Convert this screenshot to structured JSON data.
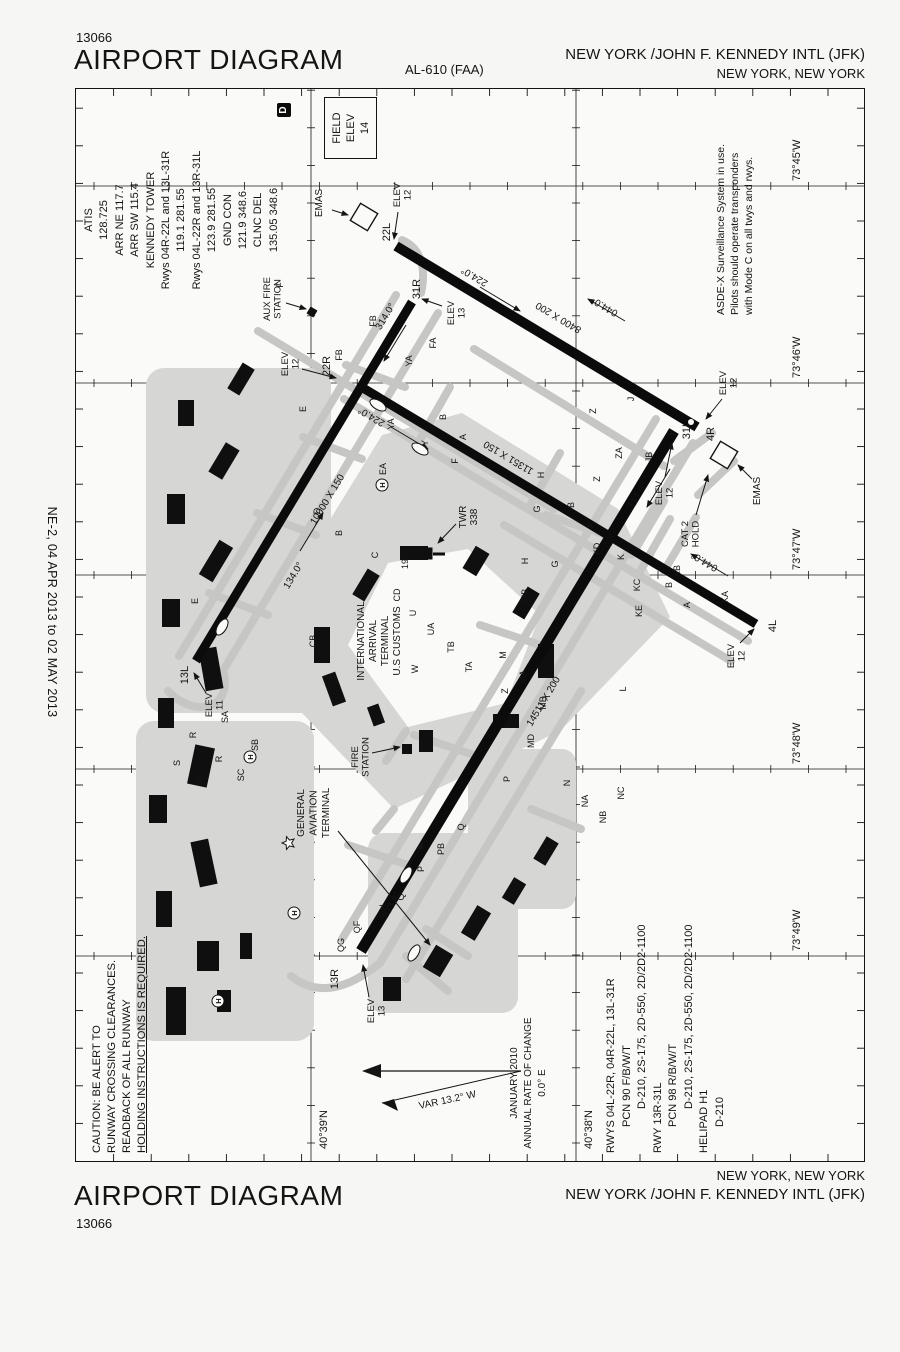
{
  "margin_notes": {
    "left": "NE-2, 04 APR 2013 to 02 MAY 2013",
    "right": "NE-2, 04 APR 2013 to 02 MAY 2013"
  },
  "header": {
    "chart_number": "13066",
    "title": "AIRPORT DIAGRAM",
    "al_ref": "AL-610 (FAA)",
    "airport": "NEW YORK /JOHN F. KENNEDY INTL (JFK)",
    "city": "NEW YORK, NEW YORK"
  },
  "footer": {
    "title": "AIRPORT DIAGRAM",
    "chart_number": "13066",
    "city": "NEW YORK, NEW YORK",
    "airport": "NEW YORK /JOHN F. KENNEDY INTL (JFK)"
  },
  "comms": {
    "lines": [
      "ATIS",
      "128.725",
      "ARR NE 117.7",
      "ARR SW 115.4",
      "KENNEDY TOWER",
      "Rwys 04R-22L and 13L-31R",
      "119.1 281.55",
      "Rwys 04L-22R and 13R-31L",
      "123.9 281.55",
      "GND CON",
      "121.9 348.6",
      "CLNC DEL",
      "135.05 348.6"
    ],
    "datis": "D"
  },
  "field_elev": {
    "line1": "FIELD",
    "line2": "ELEV",
    "value": "14"
  },
  "notes": {
    "asde": [
      "ASDE-X Surveillance System in use.",
      "Pilots should operate transponders",
      "with Mode C on all twys and rwys."
    ],
    "caution": [
      "CAUTION: BE ALERT TO",
      "RUNWAY CROSSING CLEARANCES.",
      "READBACK OF ALL RUNWAY"
    ],
    "caution_underlined": "HOLDING INSTRUCTIONS IS REQUIRED."
  },
  "variation": {
    "var_label": "VAR 13.2° W",
    "lines": [
      "JANUARY 2010",
      "ANNUAL RATE OF CHANGE",
      "0.0° E"
    ]
  },
  "runway_data": [
    "RWYS 04L-22R, 04R-22L, 13L-31R",
    "PCN 90 F/B/W/T",
    "D-210, 2S-175, 2D-550, 2D/2D2-1100",
    "RWY 13R-31L",
    "PCN 98 R/B/W/T",
    "D-210, 2S-175, 2D-550, 2D/2D2-1100",
    "HELIPAD H1",
    "D-210"
  ],
  "graticule": {
    "longitudes": [
      "73°45'W",
      "73°46'W",
      "73°47'W",
      "73°48'W",
      "73°49'W"
    ],
    "latitudes": [
      "40°39'N",
      "40°38'N"
    ]
  },
  "map": {
    "runways": [
      {
        "id": "04R-22L",
        "end_a": "4R",
        "end_b": "22L",
        "dim": "8400 X 200",
        "hdg_a": "044.0°",
        "hdg_b": "224.0°",
        "elev_a": "ELEV 12",
        "elev_b": "ELEV 12"
      },
      {
        "id": "04L-22R",
        "end_a": "4L",
        "end_b": "22R",
        "dim": "11351 X 150",
        "hdg_a": "044.0°",
        "hdg_b": "224.0°",
        "elev_a": "ELEV 12",
        "elev_b": "ELEV 12"
      },
      {
        "id": "13L-31R",
        "end_a": "13L",
        "end_b": "31R",
        "dim": "10000 X 150",
        "hdg_a": "134.0°",
        "hdg_b": "314.0°",
        "elev_a": "ELEV 11",
        "elev_b": "ELEV 13"
      },
      {
        "id": "13R-31L",
        "end_a": "13R",
        "end_b": "31L",
        "dim": "14511 X 200",
        "hdg_a": "133.9°",
        "hdg_b": "314.0°",
        "elev_a": "ELEV 13",
        "elev_b": "ELEV 12"
      }
    ],
    "pois": {
      "emas": "EMAS",
      "cat2_hold": [
        "CAT 2",
        "HOLD"
      ],
      "twr": [
        "TWR",
        "338"
      ],
      "obstruction": "197",
      "intl_terminal": [
        "INTERNATIONAL",
        "ARRIVAL",
        "TERMINAL",
        "U.S CUSTOMS"
      ],
      "ga_terminal": [
        "GENERAL",
        "AVIATION",
        "TERMINAL"
      ],
      "fire_station": [
        "FIRE",
        "STATION"
      ],
      "aux_fire_station": [
        "AUX FIRE",
        "STATION"
      ],
      "helipad_letter": "H"
    },
    "taxiway_labels": [
      {
        "t": "E",
        "x": 560,
        "y": 122
      },
      {
        "t": "E",
        "x": 752,
        "y": 230
      },
      {
        "t": "FB",
        "x": 806,
        "y": 266
      },
      {
        "t": "FB",
        "x": 840,
        "y": 300
      },
      {
        "t": "F",
        "x": 876,
        "y": 207
      },
      {
        "t": "F",
        "x": 700,
        "y": 382
      },
      {
        "t": "F",
        "x": 728,
        "y": 598
      },
      {
        "t": "FA",
        "x": 818,
        "y": 360
      },
      {
        "t": "YA",
        "x": 800,
        "y": 336
      },
      {
        "t": "YA",
        "x": 737,
        "y": 318
      },
      {
        "t": "Y",
        "x": 718,
        "y": 352
      },
      {
        "t": "EA",
        "x": 692,
        "y": 310
      },
      {
        "t": "H",
        "x": 686,
        "y": 468
      },
      {
        "t": "H",
        "x": 600,
        "y": 452
      },
      {
        "t": "HB",
        "x": 566,
        "y": 452
      },
      {
        "t": "Z",
        "x": 750,
        "y": 520
      },
      {
        "t": "Z",
        "x": 682,
        "y": 524
      },
      {
        "t": "Z",
        "x": 470,
        "y": 432
      },
      {
        "t": "ZA",
        "x": 708,
        "y": 546
      },
      {
        "t": "J",
        "x": 762,
        "y": 558
      },
      {
        "t": "JB",
        "x": 704,
        "y": 576
      },
      {
        "t": "G",
        "x": 652,
        "y": 464
      },
      {
        "t": "G",
        "x": 597,
        "y": 482
      },
      {
        "t": "L",
        "x": 472,
        "y": 550
      },
      {
        "t": "A",
        "x": 724,
        "y": 390
      },
      {
        "t": "B",
        "x": 744,
        "y": 370
      },
      {
        "t": "A",
        "x": 636,
        "y": 518
      },
      {
        "t": "B",
        "x": 656,
        "y": 498
      },
      {
        "t": "A",
        "x": 556,
        "y": 614
      },
      {
        "t": "B",
        "x": 576,
        "y": 596
      },
      {
        "t": "M",
        "x": 506,
        "y": 430
      },
      {
        "t": "MA",
        "x": 484,
        "y": 450
      },
      {
        "t": "MB",
        "x": 458,
        "y": 470
      },
      {
        "t": "W",
        "x": 492,
        "y": 342
      },
      {
        "t": "C",
        "x": 606,
        "y": 302
      },
      {
        "t": "CD",
        "x": 566,
        "y": 324
      },
      {
        "t": "CB",
        "x": 520,
        "y": 240
      },
      {
        "t": "B",
        "x": 628,
        "y": 266
      },
      {
        "t": "U",
        "x": 548,
        "y": 340
      },
      {
        "t": "UA",
        "x": 532,
        "y": 358
      },
      {
        "t": "TB",
        "x": 514,
        "y": 378
      },
      {
        "t": "TA",
        "x": 494,
        "y": 396
      },
      {
        "t": "D",
        "x": 650,
        "y": 244
      },
      {
        "t": "N",
        "x": 378,
        "y": 494
      },
      {
        "t": "NA",
        "x": 360,
        "y": 512
      },
      {
        "t": "NB",
        "x": 344,
        "y": 530
      },
      {
        "t": "NC",
        "x": 368,
        "y": 548
      },
      {
        "t": "S",
        "x": 398,
        "y": 104
      },
      {
        "t": "SD",
        "x": 382,
        "y": 126
      },
      {
        "t": "R",
        "x": 402,
        "y": 146
      },
      {
        "t": "SC",
        "x": 386,
        "y": 168
      },
      {
        "t": "SB",
        "x": 416,
        "y": 182
      },
      {
        "t": "SA",
        "x": 444,
        "y": 152
      },
      {
        "t": "R",
        "x": 426,
        "y": 120
      },
      {
        "t": "QG",
        "x": 216,
        "y": 268
      },
      {
        "t": "QF",
        "x": 234,
        "y": 284
      },
      {
        "t": "QH",
        "x": 250,
        "y": 310
      },
      {
        "t": "Q",
        "x": 264,
        "y": 328
      },
      {
        "t": "P",
        "x": 292,
        "y": 348
      },
      {
        "t": "PB",
        "x": 312,
        "y": 368
      },
      {
        "t": "Q",
        "x": 334,
        "y": 388
      },
      {
        "t": "MD",
        "x": 420,
        "y": 458
      },
      {
        "t": "P",
        "x": 382,
        "y": 434
      },
      {
        "t": "K",
        "x": 604,
        "y": 548
      },
      {
        "t": "KA",
        "x": 564,
        "y": 652
      },
      {
        "t": "KB",
        "x": 590,
        "y": 604
      },
      {
        "t": "KC",
        "x": 576,
        "y": 564
      },
      {
        "t": "KD",
        "x": 612,
        "y": 524
      },
      {
        "t": "KE",
        "x": 550,
        "y": 566
      }
    ]
  }
}
